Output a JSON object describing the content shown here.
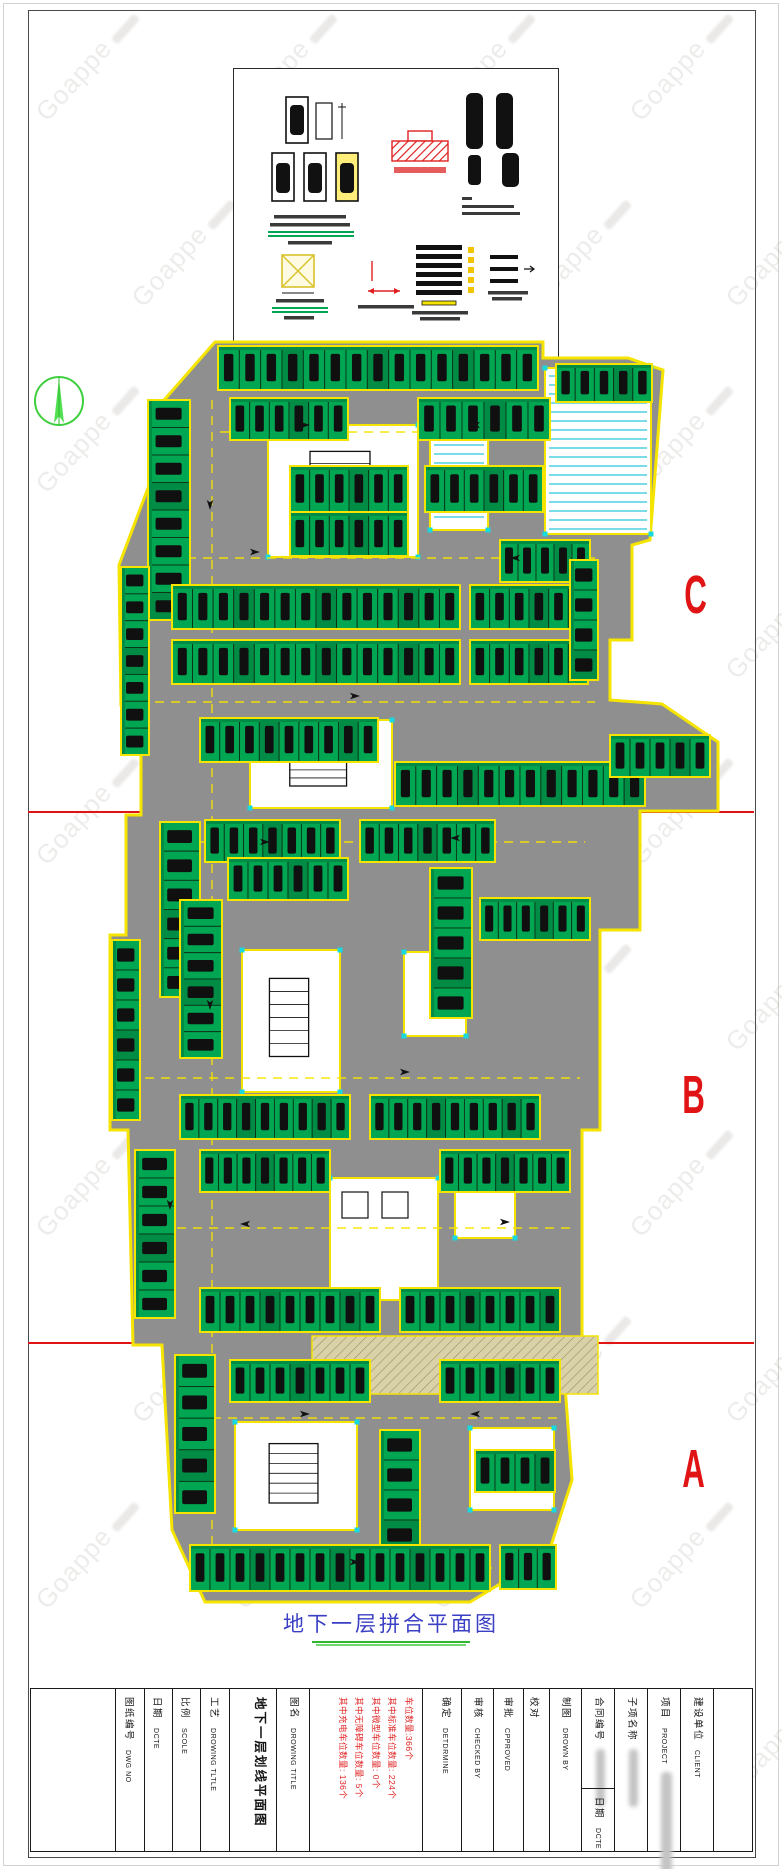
{
  "watermark": {
    "text": "Goappe"
  },
  "plan": {
    "title": "地下一层拼合平面图",
    "section_labels": [
      {
        "text": "C",
        "x": 676,
        "y": 568
      },
      {
        "text": "B",
        "x": 674,
        "y": 1068
      },
      {
        "text": "A",
        "x": 674,
        "y": 1442
      }
    ],
    "red_line_ys": [
      811,
      1342
    ],
    "colors": {
      "road": "#8f8f8f",
      "wall": "#f5e400",
      "stall": "#00a651",
      "stall_dark": "#008c45",
      "stall_border": "#0d3317",
      "car": "#101010",
      "cyan": "#19d8e0",
      "ramp": "#d9d2a8"
    },
    "boundary": "215,342 543,342 543,358 628,358 663,370 650,540 632,545 632,640 610,640 610,700 662,704 718,742 718,811 640,811 640,930 600,930 600,1130 582,1130 582,1345 562,1345 572,1480 548,1555 470,1602 205,1602 172,1530 162,1345 133,1345 128,1130 110,1130 110,935 126,935 126,815 141,815 141,705 121,705 119,565 151,480 151,415",
    "rooms": [
      [
        268,
        425,
        150,
        132,
        "grid"
      ],
      [
        430,
        428,
        58,
        102,
        "cyan"
      ],
      [
        545,
        368,
        106,
        166,
        "cyan"
      ],
      [
        250,
        720,
        142,
        88,
        "grid"
      ],
      [
        404,
        952,
        62,
        84,
        ""
      ],
      [
        242,
        950,
        98,
        142,
        "grid"
      ],
      [
        330,
        1178,
        108,
        122,
        "inner"
      ],
      [
        235,
        1422,
        122,
        108,
        "grid"
      ],
      [
        470,
        1428,
        84,
        82,
        ""
      ],
      [
        455,
        1178,
        60,
        60,
        ""
      ]
    ],
    "strips": [
      [
        218,
        346,
        320,
        44,
        15,
        "h"
      ],
      [
        556,
        364,
        96,
        38,
        5,
        "h"
      ],
      [
        230,
        398,
        118,
        42,
        6,
        "h"
      ],
      [
        418,
        398,
        132,
        42,
        6,
        "h"
      ],
      [
        148,
        400,
        42,
        220,
        8,
        "v"
      ],
      [
        290,
        466,
        118,
        46,
        6,
        "h"
      ],
      [
        290,
        512,
        118,
        44,
        6,
        "h"
      ],
      [
        425,
        466,
        118,
        46,
        6,
        "h"
      ],
      [
        500,
        540,
        90,
        42,
        5,
        "h"
      ],
      [
        172,
        585,
        288,
        44,
        14,
        "h"
      ],
      [
        470,
        585,
        118,
        44,
        6,
        "h"
      ],
      [
        172,
        640,
        288,
        44,
        14,
        "h"
      ],
      [
        470,
        640,
        118,
        44,
        6,
        "h"
      ],
      [
        121,
        567,
        28,
        188,
        7,
        "v"
      ],
      [
        200,
        718,
        178,
        44,
        9,
        "h"
      ],
      [
        395,
        762,
        250,
        44,
        12,
        "h"
      ],
      [
        610,
        735,
        100,
        42,
        5,
        "h"
      ],
      [
        570,
        560,
        28,
        120,
        4,
        "v"
      ],
      [
        160,
        822,
        40,
        175,
        6,
        "v"
      ],
      [
        205,
        820,
        135,
        42,
        7,
        "h"
      ],
      [
        360,
        820,
        135,
        42,
        7,
        "h"
      ],
      [
        112,
        940,
        28,
        180,
        6,
        "v"
      ],
      [
        180,
        900,
        42,
        158,
        6,
        "v"
      ],
      [
        228,
        858,
        120,
        42,
        6,
        "h"
      ],
      [
        430,
        868,
        42,
        150,
        5,
        "v"
      ],
      [
        480,
        898,
        110,
        42,
        6,
        "h"
      ],
      [
        180,
        1095,
        170,
        44,
        9,
        "h"
      ],
      [
        370,
        1095,
        170,
        44,
        9,
        "h"
      ],
      [
        135,
        1150,
        40,
        168,
        6,
        "v"
      ],
      [
        200,
        1150,
        130,
        42,
        7,
        "h"
      ],
      [
        440,
        1150,
        130,
        42,
        7,
        "h"
      ],
      [
        200,
        1288,
        180,
        44,
        9,
        "h"
      ],
      [
        400,
        1288,
        160,
        44,
        8,
        "h"
      ],
      [
        175,
        1355,
        40,
        158,
        5,
        "v"
      ],
      [
        230,
        1360,
        140,
        42,
        7,
        "h"
      ],
      [
        380,
        1430,
        40,
        120,
        4,
        "v"
      ],
      [
        440,
        1360,
        120,
        42,
        6,
        "h"
      ],
      [
        475,
        1450,
        80,
        42,
        4,
        "h"
      ],
      [
        190,
        1545,
        300,
        46,
        15,
        "h"
      ],
      [
        500,
        1545,
        56,
        44,
        3,
        "h"
      ]
    ],
    "dashes": [
      [
        220,
        432,
        540,
        432
      ],
      [
        155,
        558,
        595,
        558
      ],
      [
        155,
        702,
        595,
        702
      ],
      [
        200,
        842,
        585,
        842
      ],
      [
        145,
        1078,
        580,
        1078
      ],
      [
        145,
        1228,
        570,
        1228
      ],
      [
        180,
        1418,
        560,
        1418
      ],
      [
        195,
        1568,
        540,
        1568
      ],
      [
        212,
        400,
        212,
        1560
      ]
    ],
    "arrows": [
      [
        300,
        425,
        0
      ],
      [
        480,
        425,
        180
      ],
      [
        250,
        552,
        0
      ],
      [
        520,
        558,
        180
      ],
      [
        350,
        696,
        0
      ],
      [
        210,
        500,
        90
      ],
      [
        460,
        838,
        180
      ],
      [
        260,
        842,
        0
      ],
      [
        210,
        1000,
        90
      ],
      [
        400,
        1072,
        0
      ],
      [
        250,
        1224,
        180
      ],
      [
        500,
        1222,
        0
      ],
      [
        300,
        1414,
        0
      ],
      [
        480,
        1414,
        180
      ],
      [
        350,
        1562,
        0
      ],
      [
        170,
        1200,
        90
      ]
    ],
    "ramp": [
      312,
      1336,
      286,
      58
    ]
  },
  "title_block": {
    "columns": [
      {
        "type": "empty",
        "w": 88
      },
      {
        "cn": "图纸编号",
        "en": "DWG NO",
        "w": 30
      },
      {
        "cn": "日期",
        "en": "DCTE",
        "w": 28
      },
      {
        "cn": "比例",
        "en": "SCOLE",
        "w": 28
      },
      {
        "cn": "工艺",
        "en": "DROWING TLTLE",
        "w": 30
      },
      {
        "type": "big",
        "cn": "地下一层划线平面图",
        "en": "",
        "w": 48
      },
      {
        "cn": "图名",
        "en": "DROWING TITLE",
        "w": 33
      },
      {
        "type": "stats",
        "w": 118
      },
      {
        "cn": "确定",
        "en": "DETDRMINE",
        "w": 40
      },
      {
        "cn": "审核",
        "en": "CHECKED BY",
        "w": 33
      },
      {
        "cn": "审批",
        "en": "CPPROVED",
        "w": 30
      },
      {
        "cn": "校对",
        "en": "",
        "w": 26
      },
      {
        "cn": "制图",
        "en": "DROWN BY",
        "w": 33
      },
      {
        "cn": "合同编号",
        "en": "",
        "w": 33,
        "value": true,
        "sub": {
          "cn": "日期",
          "en": "DCTE"
        }
      },
      {
        "cn": "子项名称",
        "en": "",
        "w": 34,
        "value": true
      },
      {
        "cn": "项目",
        "en": "PROJECT",
        "w": 34,
        "value": true,
        "bigblur": true
      },
      {
        "cn": "建设单位",
        "en": "CLIENT",
        "w": 33
      },
      {
        "type": "empty",
        "w": 40
      }
    ],
    "stats_lines": [
      "车位数量:366个",
      "其中标准车位数量: 224个",
      "其中微型车位数量: 0个",
      "其中无障碍车位数量: 5个",
      "其中充电车位数量: 136个"
    ]
  }
}
